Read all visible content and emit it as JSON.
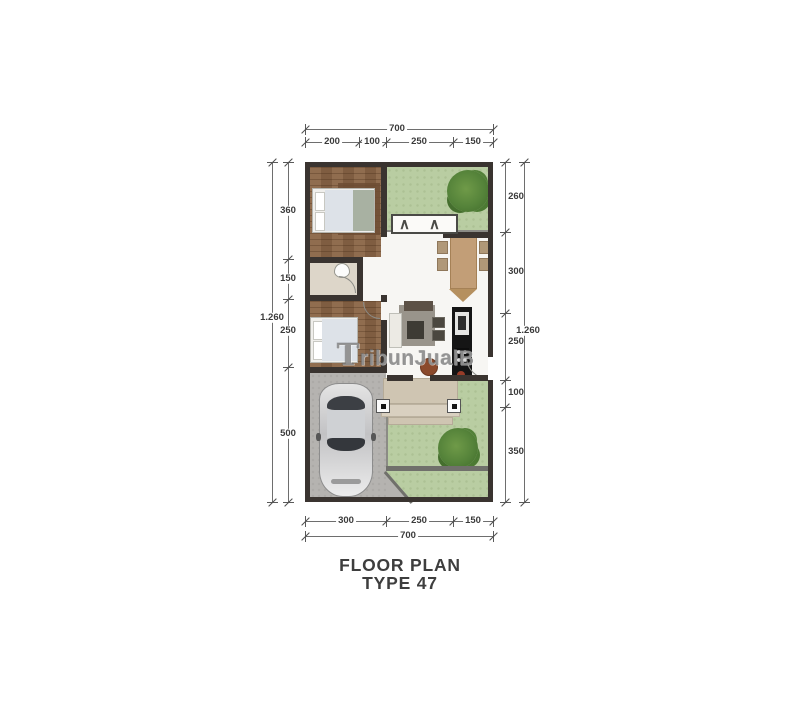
{
  "watermark": {
    "text": "TribunJualB"
  },
  "title": {
    "line1": "FLOOR PLAN",
    "line2": "TYPE 47"
  },
  "dimensions": {
    "top": {
      "total": "700",
      "segments": [
        "200",
        "100",
        "250",
        "150"
      ]
    },
    "bottom": {
      "total": "700",
      "segments": [
        "300",
        "250",
        "150"
      ]
    },
    "left": {
      "total": "1.260",
      "segments": [
        "360",
        "150",
        "250",
        "500"
      ]
    },
    "right": {
      "total": "1.260",
      "segments": [
        "260",
        "300",
        "250",
        "100",
        "350"
      ]
    }
  },
  "glyphs": {
    "window": "∧"
  },
  "colors": {
    "wall": "#3a3430",
    "garden_green": "#b9cda2",
    "wood_floor": "#8a6546",
    "carport_gray": "#b5b3b0",
    "terrace_beige": "#d3c9b6",
    "kitchen_black": "#151515",
    "dining_table_tan": "#c29e77",
    "dim_text": "#3b3b3b"
  }
}
